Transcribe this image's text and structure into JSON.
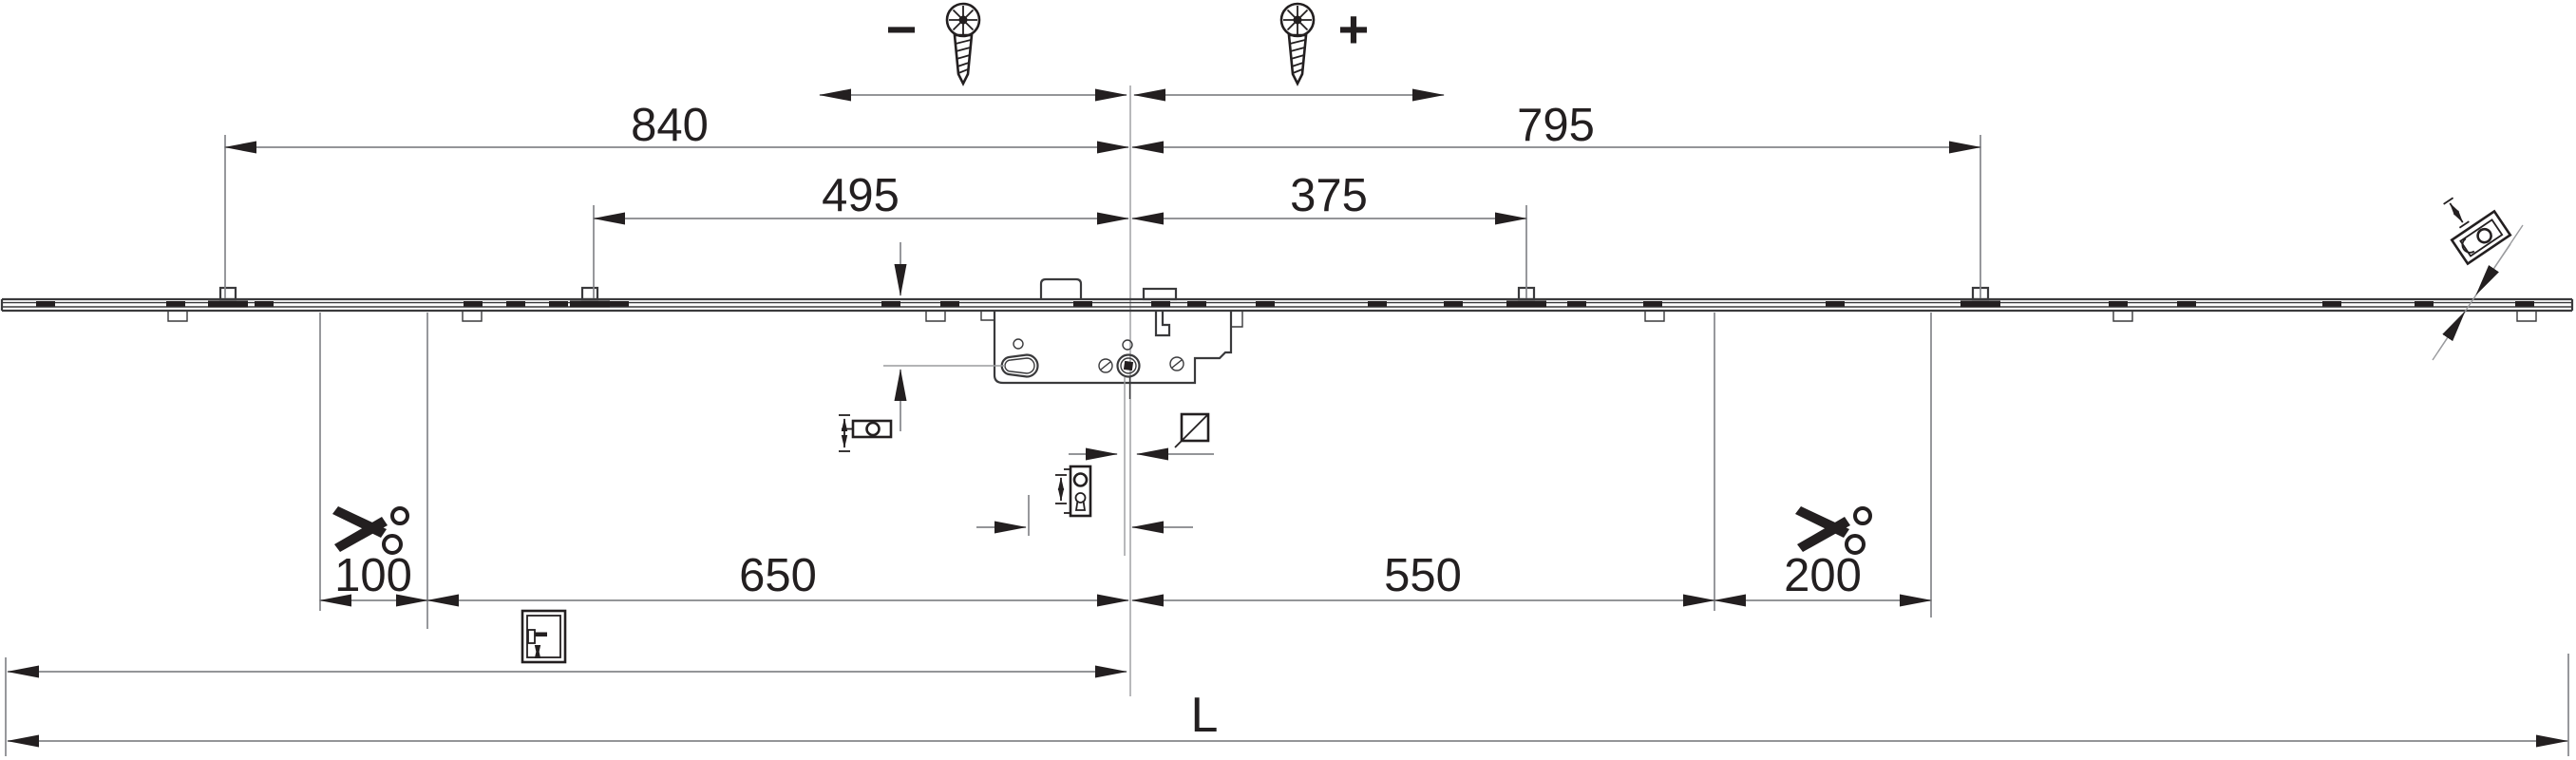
{
  "drawing": {
    "type": "technical-dimension-drawing",
    "subject": "multipoint-lock-faceplate",
    "colors": {
      "background": "#ffffff",
      "ink": "#231f20",
      "object_line": "#3a3a3c",
      "dimension_line": "#85868a"
    },
    "dims": {
      "adjust_minus": "−",
      "adjust_plus": "+",
      "upper_left": "840",
      "upper_right": "795",
      "inner_left": "495",
      "inner_right": "375",
      "cut_left": "100",
      "lower_left": "650",
      "lower_right": "550",
      "cut_right": "200",
      "total_length": "L"
    },
    "icons": [
      "screw-icon-left",
      "screw-icon-right",
      "scissors-cut-icon-left",
      "scissors-cut-icon-right",
      "roller-cam-height-adjust-icon",
      "square-spindle-icon",
      "handle-cylinder-plate-icon",
      "door-handle-height-icon",
      "tilt-cam-adjust-icon"
    ]
  }
}
